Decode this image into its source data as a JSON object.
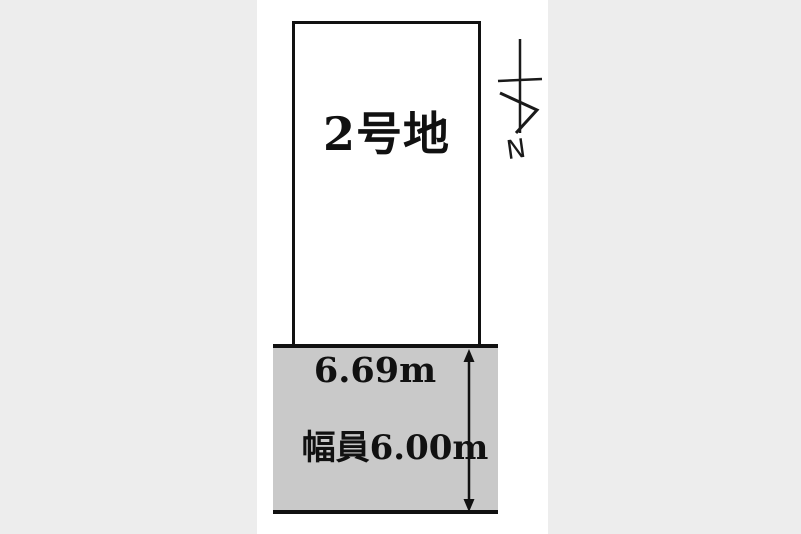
{
  "diagram": {
    "plot_label": "2号地",
    "frontage_label": "6.69m",
    "road_width_label": "幅員6.00m",
    "compass_label": "N",
    "colors": {
      "background": "#ededed",
      "page": "#ffffff",
      "road_fill": "#c9c9c9",
      "line": "#111111"
    }
  }
}
